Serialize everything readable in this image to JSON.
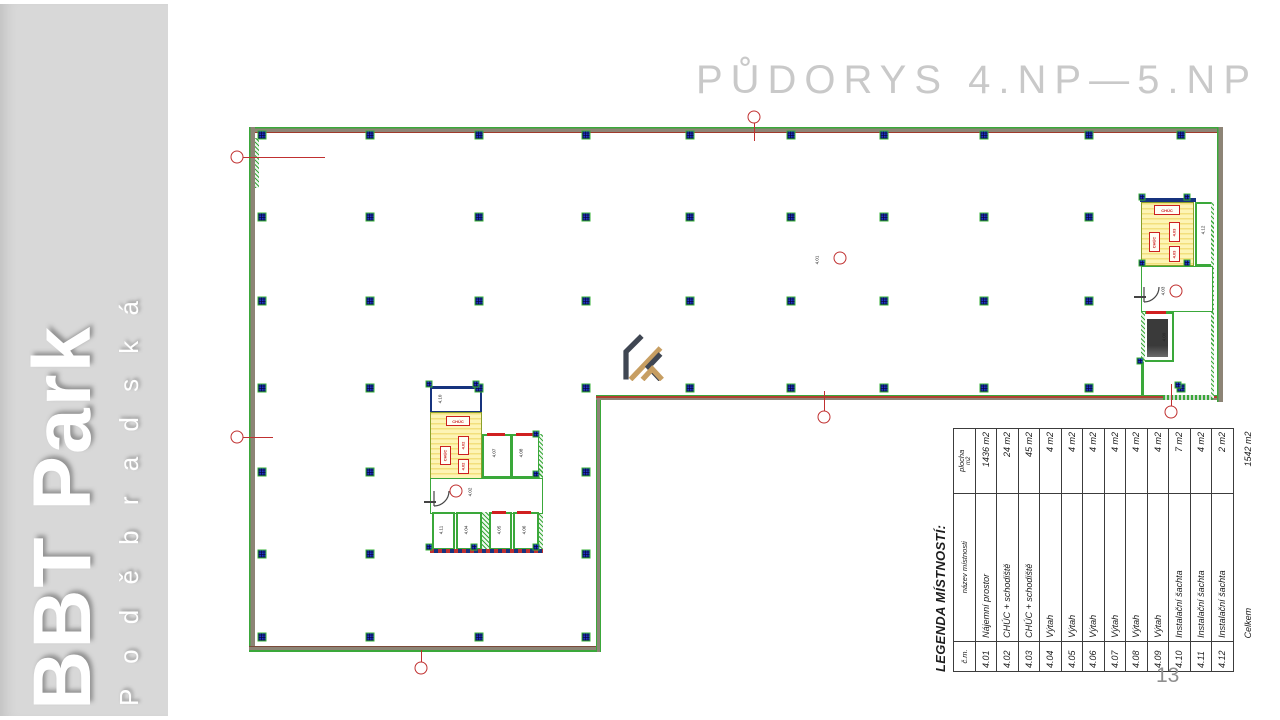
{
  "slide": {
    "page_number": "13"
  },
  "sidebar": {
    "title": "BBT Park",
    "subtitle": "P o d ě b r a d s k á"
  },
  "header": {
    "title": "PŮDORYS 4.NP—5.NP"
  },
  "logo": {
    "name": "kaprain-monogram",
    "dark_color": "#3f4652",
    "gold_color": "#c79e62"
  },
  "colors": {
    "wall_green": "#3aa83a",
    "wall_gray": "#8d8476",
    "accent_red": "#c03030",
    "column_blue": "#2036c8",
    "stair_yellow": "#fdf4b5",
    "core_navy": "#16337e",
    "title_gray": "#c9c9c9",
    "sidebar_gray": "#d8d8d8"
  },
  "plan": {
    "grid": {
      "columns_x": [
        262,
        370,
        479,
        586,
        690,
        791,
        884,
        984,
        1089,
        1181
      ],
      "rows_y": [
        135,
        217,
        301,
        388
      ],
      "left_columns_x": [
        262,
        370,
        479,
        586
      ],
      "left_rows_y": [
        472,
        554,
        637
      ],
      "skip": [
        [
          1181,
          217
        ],
        [
          1181,
          301
        ],
        [
          479,
          472
        ],
        [
          479,
          554
        ]
      ]
    },
    "core_dots": [
      [
        429,
        384
      ],
      [
        476,
        384
      ],
      [
        536,
        434
      ],
      [
        536,
        474
      ],
      [
        429,
        547
      ],
      [
        474,
        547
      ],
      [
        536,
        547
      ],
      [
        1142,
        197
      ],
      [
        1187,
        197
      ],
      [
        1142,
        263
      ],
      [
        1187,
        263
      ],
      [
        1178,
        385
      ],
      [
        1140,
        361
      ]
    ],
    "markers": [
      {
        "x": 237,
        "y": 157,
        "dir": "right",
        "len": 82
      },
      {
        "x": 237,
        "y": 437,
        "dir": "right",
        "len": 30
      },
      {
        "x": 754,
        "y": 117,
        "dir": "down",
        "len": 18
      },
      {
        "x": 421,
        "y": 668,
        "dir": "up",
        "len": 12
      },
      {
        "x": 824,
        "y": 417,
        "dir": "up",
        "len": 20
      },
      {
        "x": 1171,
        "y": 412,
        "dir": "up",
        "len": 22
      }
    ],
    "room_tags": [
      {
        "label": "4.01",
        "x": 817,
        "y": 260
      },
      {
        "label": "4.10",
        "x": 440,
        "y": 399
      },
      {
        "label": "4.07",
        "x": 494,
        "y": 453
      },
      {
        "label": "4.08",
        "x": 521,
        "y": 453
      },
      {
        "label": "4.02",
        "x": 470,
        "y": 492
      },
      {
        "label": "4.11",
        "x": 441,
        "y": 530
      },
      {
        "label": "4.04",
        "x": 466,
        "y": 530
      },
      {
        "label": "4.05",
        "x": 499,
        "y": 530
      },
      {
        "label": "4.06",
        "x": 524,
        "y": 530
      },
      {
        "label": "4.12",
        "x": 1203,
        "y": 230
      },
      {
        "label": "4.03",
        "x": 1163,
        "y": 291
      },
      {
        "label": "4.09",
        "x": 1164,
        "y": 337
      }
    ],
    "tag_circles": [
      [
        456,
        491
      ],
      [
        1176,
        291
      ],
      [
        840,
        258
      ]
    ],
    "fire_tags": [
      {
        "label": "CHÚC",
        "x": 458,
        "y": 421,
        "w": 24,
        "h": 10,
        "v": false
      },
      {
        "label": "4.02",
        "x": 463,
        "y": 445,
        "w": 11,
        "h": 19,
        "v": true
      },
      {
        "label": "CHÚC",
        "x": 445,
        "y": 455,
        "w": 11,
        "h": 19,
        "v": true
      },
      {
        "label": "4.02",
        "x": 463,
        "y": 466,
        "w": 11,
        "h": 15,
        "v": true
      },
      {
        "label": "CHÚC",
        "x": 1167,
        "y": 210,
        "w": 26,
        "h": 10,
        "v": false
      },
      {
        "label": "4.03",
        "x": 1174,
        "y": 232,
        "w": 11,
        "h": 20,
        "v": true
      },
      {
        "label": "CHÚC",
        "x": 1154,
        "y": 242,
        "w": 11,
        "h": 20,
        "v": true
      },
      {
        "label": "4.03",
        "x": 1174,
        "y": 254,
        "w": 11,
        "h": 16,
        "v": true
      }
    ]
  },
  "legend": {
    "title": "LEGENDA MÍSTNOSTÍ:",
    "columns": [
      "č.m.",
      "název místnosti",
      "plocha"
    ],
    "area_unit": "m2",
    "rows": [
      {
        "num": "4.01",
        "name": "Nájemní prostor",
        "area": "1436 m2"
      },
      {
        "num": "4.02",
        "name": "CHÚC + schodiště",
        "area": "24 m2"
      },
      {
        "num": "4.03",
        "name": "CHÚC + schodiště",
        "area": "45 m2"
      },
      {
        "num": "4.04",
        "name": "Výtah",
        "area": "4 m2"
      },
      {
        "num": "4.05",
        "name": "Výtah",
        "area": "4 m2"
      },
      {
        "num": "4.06",
        "name": "Výtah",
        "area": "4 m2"
      },
      {
        "num": "4.07",
        "name": "Výtah",
        "area": "4 m2"
      },
      {
        "num": "4.08",
        "name": "Výtah",
        "area": "4 m2"
      },
      {
        "num": "4.09",
        "name": "Výtah",
        "area": "4 m2"
      },
      {
        "num": "4.10",
        "name": "Instalační šachta",
        "area": "7 m2"
      },
      {
        "num": "4.11",
        "name": "Instalační šachta",
        "area": "4 m2"
      },
      {
        "num": "4.12",
        "name": "Instalační šachta",
        "area": "2 m2"
      }
    ],
    "total": {
      "label": "Celkem",
      "area": "1542 m2"
    }
  }
}
